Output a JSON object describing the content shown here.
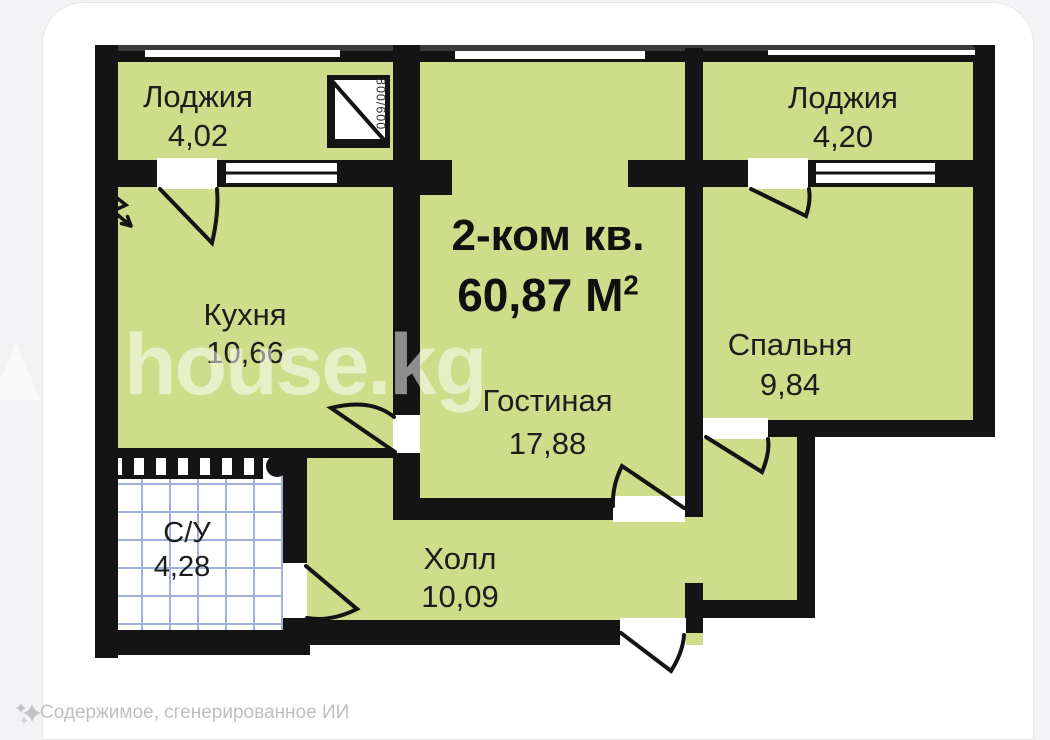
{
  "plan_type": "apartment-floor-plan",
  "title": {
    "line1": "2-ком кв.",
    "area": "60,87 М",
    "sup": "2"
  },
  "rooms": {
    "loggia_left": {
      "name": "Лоджия",
      "area": "4,02"
    },
    "loggia_right": {
      "name": "Лоджия",
      "area": "4,20"
    },
    "kitchen": {
      "name": "Кухня",
      "area": "10,66"
    },
    "living": {
      "name": "Гостиная",
      "area": "17,88"
    },
    "bedroom": {
      "name": "Спальня",
      "area": "9,84"
    },
    "bathroom": {
      "name": "С/У",
      "area": "4,28"
    },
    "hall": {
      "name": "Холл",
      "area": "10,09"
    }
  },
  "annotations": {
    "window_size": "800/600"
  },
  "watermark": {
    "text": "house.kg",
    "icon": "house-roof-icon"
  },
  "footer": {
    "text": "Содержимое, сгенерированное ИИ",
    "icon": "ai-sparkle-icon"
  },
  "colors": {
    "room_fill": "#cddd8a",
    "wall": "#141414",
    "tile_grid": "#a3b0da",
    "watermark_text": "rgba(255,255,255,0.52)",
    "footer_text": "#bfbfc1",
    "page_background": "#f3f3f5",
    "card_background": "#ffffff"
  }
}
